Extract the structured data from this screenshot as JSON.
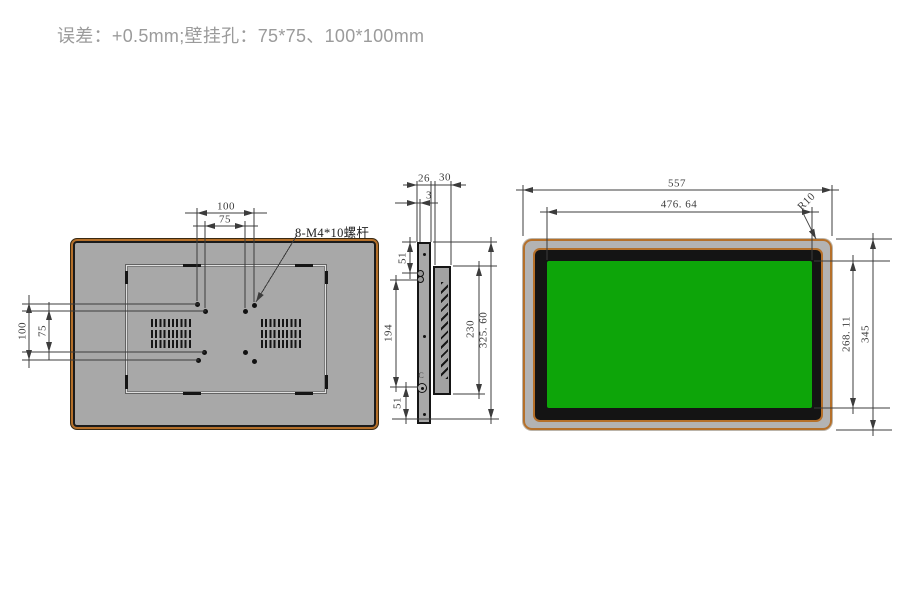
{
  "page": {
    "tolerance_note": "误差：+0.5mm;壁挂孔：75*75、100*100mm"
  },
  "rear_view": {
    "screw_note": "8-M4*10螺杆",
    "dims": {
      "hole_span_h_outer": "100",
      "hole_span_h_inner": "75",
      "hole_span_v_outer": "100",
      "hole_span_v_inner": "75"
    }
  },
  "side_view": {
    "dims": {
      "depth_front": "26",
      "depth_total": "30",
      "front_lip": "3",
      "top_offset": "51",
      "mid_span": "194",
      "bottom_offset": "51",
      "rear_body_height": "230",
      "overall_height": "325. 60"
    },
    "marks": {
      "clip": "C"
    }
  },
  "front_view": {
    "dims": {
      "overall_width": "557",
      "viewable_width": "476. 64",
      "viewable_height": "268. 11",
      "overall_height": "345",
      "corner_radius": "R10"
    }
  },
  "colors": {
    "accent_orange": "#b5702a",
    "panel_gray": "#a8a8a8",
    "bezel_gray": "#b3b3b3",
    "screen_green": "#0da509",
    "frame_black": "#141414",
    "line_color": "#3c3c3c",
    "dim_text": "#3c3c3c",
    "title_text": "#9b9b9b",
    "background": "#ffffff"
  }
}
